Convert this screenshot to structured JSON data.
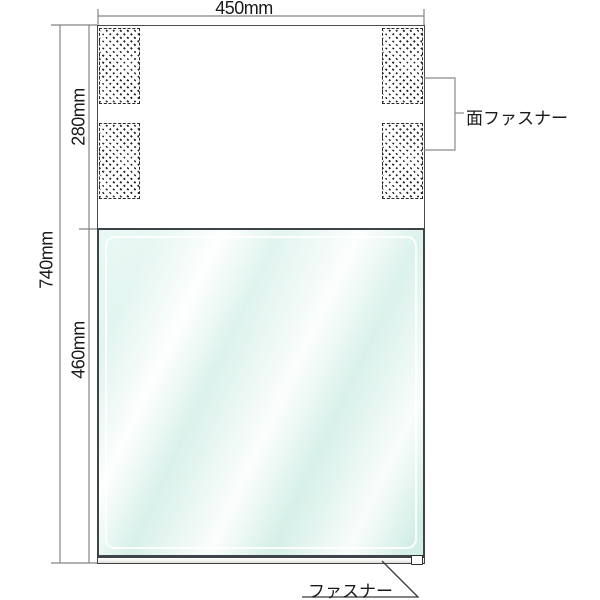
{
  "dimensions": {
    "width_total": "450mm",
    "height_total": "740mm",
    "upper_section_height": "280mm",
    "window_section_height": "460mm"
  },
  "callouts": {
    "velcro": "面ファスナー",
    "zipper": "ファスナー"
  },
  "colors": {
    "background": "#ffffff",
    "panel_outline": "#4a4a4a",
    "window_border": "#3e4447",
    "window_tint": "#dcf2ec",
    "dimension_lines": "#858585",
    "leader_lines": "#3a3a3a",
    "hatch_marks": "#2a2a2a",
    "text": "#1a1a1a"
  }
}
